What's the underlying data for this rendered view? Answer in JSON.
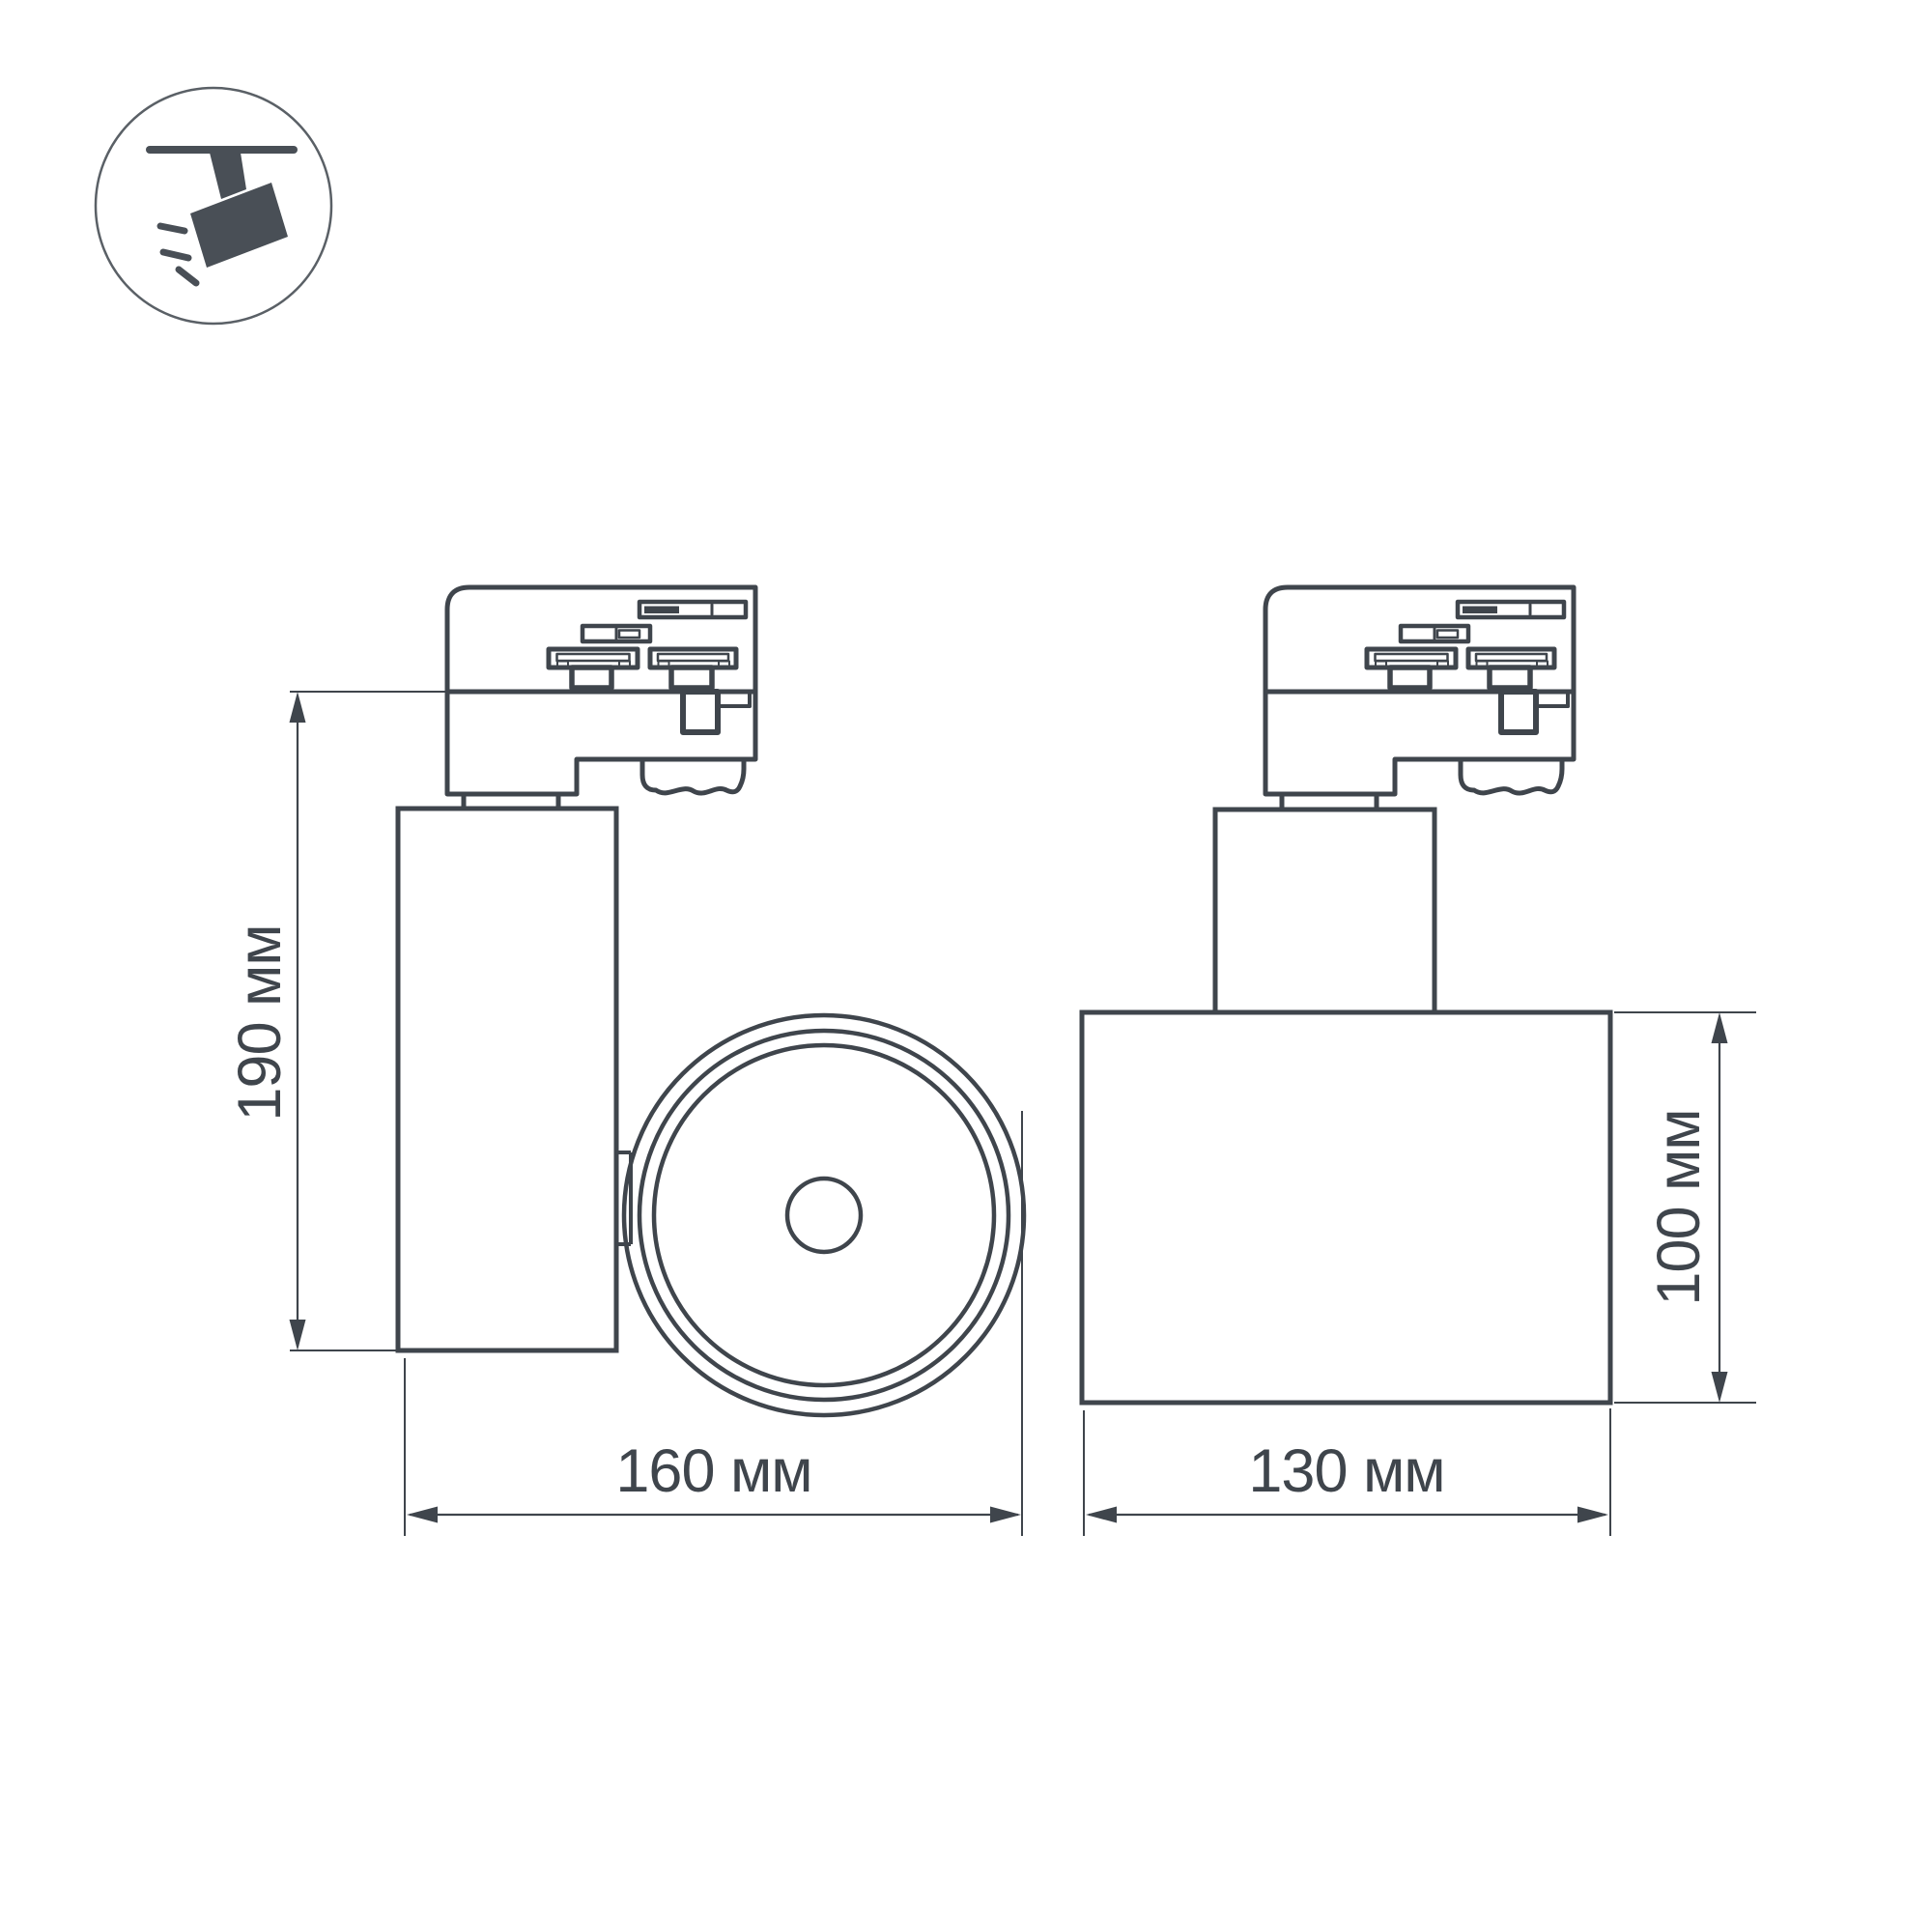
{
  "meta": {
    "type": "technical-dimension-drawing",
    "background": "#ffffff"
  },
  "icon": {
    "semantic": "ceiling-track-spotlight-icon",
    "glyph_color": "#494f56",
    "ring_color": "#5a6066"
  },
  "style": {
    "line_color": "#3f454c",
    "text_color": "#3f454c"
  },
  "labels": {
    "side_height": "190 мм",
    "side_width": "160 мм",
    "front_width": "130 мм",
    "front_height": "100 мм"
  }
}
